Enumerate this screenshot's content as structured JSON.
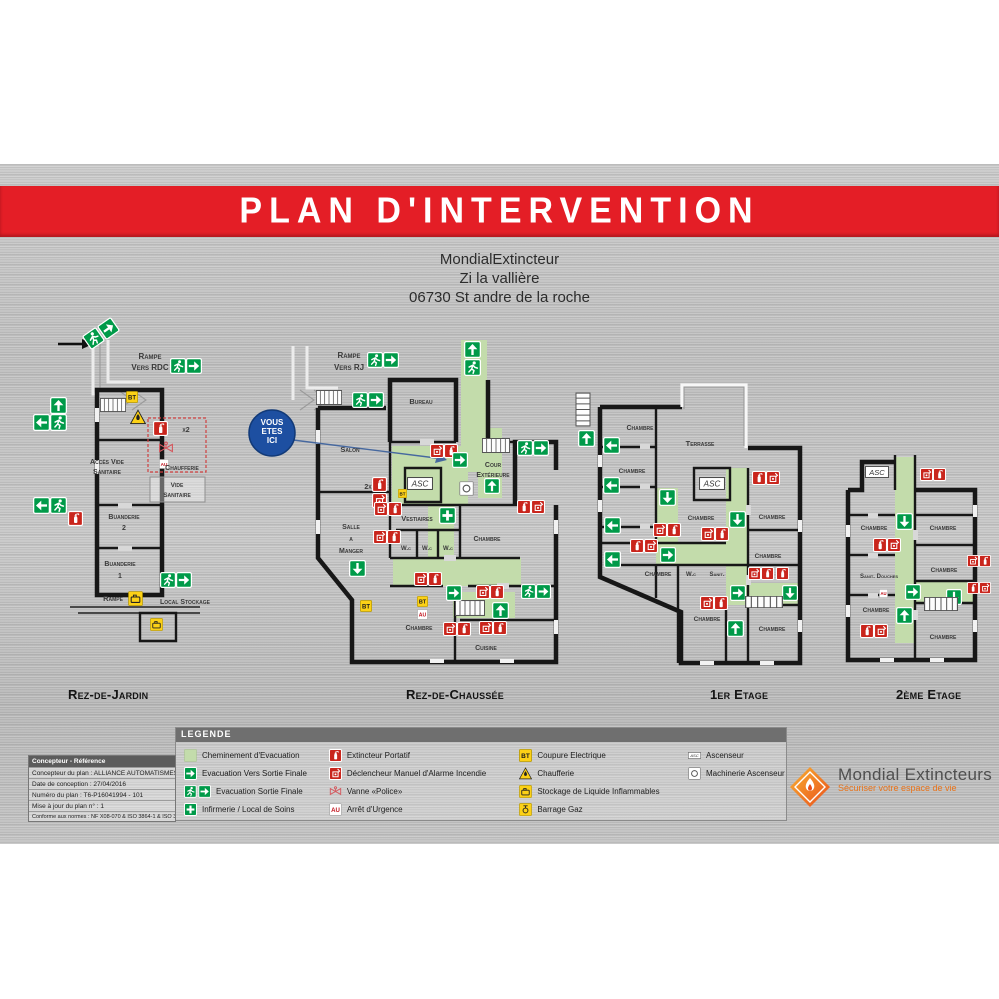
{
  "poster": {
    "title": "PLAN D'INTERVENTION",
    "address_lines": [
      "MondialExtincteur",
      "Zi la vallière",
      "06730 St andre de la roche"
    ],
    "you_are_here": [
      "VOUS",
      "ETES",
      "ICI"
    ]
  },
  "colors": {
    "banner_red": "#e41e26",
    "safety_green": "#009a49",
    "evacuation_path_green": "#c3dcab",
    "icon_red": "#c9251c",
    "icon_yellow": "#fcd116",
    "you_are_here_blue": "#1d4fa1"
  },
  "floors": [
    {
      "id": "rdj",
      "label": "Rez-de-Jardin",
      "texts": [
        {
          "t": "Rampe",
          "x": 150,
          "y": 359,
          "s": 8
        },
        {
          "t": "Vers RDC",
          "x": 150,
          "y": 370,
          "s": 8
        },
        {
          "t": "x2",
          "x": 186,
          "y": 432,
          "s": 7
        },
        {
          "t": "Accès Vide",
          "x": 107,
          "y": 464,
          "s": 7
        },
        {
          "t": "Sanitaire",
          "x": 107,
          "y": 474,
          "s": 7
        },
        {
          "t": "Chaufferie",
          "x": 182,
          "y": 470,
          "s": 7
        },
        {
          "t": "Vide",
          "x": 177,
          "y": 487,
          "s": 6.5
        },
        {
          "t": "Sanitaire",
          "x": 177,
          "y": 497,
          "s": 6.5
        },
        {
          "t": "Buanderie",
          "x": 124,
          "y": 519,
          "s": 7
        },
        {
          "t": "2",
          "x": 124,
          "y": 530,
          "s": 7
        },
        {
          "t": "Buanderie",
          "x": 120,
          "y": 566,
          "s": 7
        },
        {
          "t": "1",
          "x": 120,
          "y": 578,
          "s": 7
        },
        {
          "t": "Rampe",
          "x": 113,
          "y": 601,
          "s": 7.5
        },
        {
          "t": "Local Stockage",
          "x": 185,
          "y": 604,
          "s": 7
        }
      ],
      "icons": [
        {
          "k": "stairs",
          "x": 100,
          "y": 398,
          "w": 26,
          "h": 14
        },
        {
          "k": "arrow",
          "x": 100,
          "y": 320,
          "s": 17,
          "r": -35
        },
        {
          "k": "runner",
          "x": 85,
          "y": 330,
          "s": 17,
          "r": -35
        },
        {
          "k": "runner",
          "x": 170,
          "y": 358,
          "s": 16
        },
        {
          "k": "arrow",
          "x": 186,
          "y": 358,
          "s": 16
        },
        {
          "k": "arrow",
          "x": 50,
          "y": 397,
          "s": 17,
          "r": 270
        },
        {
          "k": "arrow",
          "x": 33,
          "y": 414,
          "s": 17,
          "r": 180
        },
        {
          "k": "runner",
          "x": 50,
          "y": 414,
          "s": 17
        },
        {
          "k": "bt",
          "x": 126,
          "y": 391,
          "s": 12
        },
        {
          "k": "warn",
          "x": 130,
          "y": 409,
          "s": 16
        },
        {
          "k": "ext",
          "x": 153,
          "y": 421,
          "s": 15
        },
        {
          "k": "vanne",
          "x": 158,
          "y": 440,
          "s": 16
        },
        {
          "k": "au",
          "x": 159,
          "y": 459,
          "s": 10
        },
        {
          "k": "arrow",
          "x": 33,
          "y": 497,
          "s": 17,
          "r": 180
        },
        {
          "k": "runner",
          "x": 50,
          "y": 497,
          "s": 17
        },
        {
          "k": "ext",
          "x": 68,
          "y": 511,
          "s": 15
        },
        {
          "k": "runner",
          "x": 160,
          "y": 572,
          "s": 16
        },
        {
          "k": "arrow",
          "x": 176,
          "y": 572,
          "s": 16
        },
        {
          "k": "store",
          "x": 128,
          "y": 591,
          "s": 15
        },
        {
          "k": "store",
          "x": 150,
          "y": 618,
          "s": 13
        }
      ]
    },
    {
      "id": "rdc",
      "label": "Rez-de-Chaussée",
      "texts": [
        {
          "t": "Rampe",
          "x": 349,
          "y": 358,
          "s": 8
        },
        {
          "t": "Vers RJ",
          "x": 349,
          "y": 370,
          "s": 8
        },
        {
          "t": "Bureau",
          "x": 421,
          "y": 404,
          "s": 7.5
        },
        {
          "t": "Salon",
          "x": 350,
          "y": 452,
          "s": 7.5
        },
        {
          "t": "2x",
          "x": 368,
          "y": 489,
          "s": 7,
          "a": "end"
        },
        {
          "t": "Cour",
          "x": 493,
          "y": 467,
          "s": 7
        },
        {
          "t": "Extérieure",
          "x": 493,
          "y": 477,
          "s": 7
        },
        {
          "t": "Vestiaires",
          "x": 417,
          "y": 521,
          "s": 7.5
        },
        {
          "t": "Salle",
          "x": 351,
          "y": 529,
          "s": 7
        },
        {
          "t": "a",
          "x": 351,
          "y": 541,
          "s": 7
        },
        {
          "t": "Manger",
          "x": 351,
          "y": 553,
          "s": 7
        },
        {
          "t": "W.c",
          "x": 406,
          "y": 550,
          "s": 6
        },
        {
          "t": "W.c",
          "x": 427,
          "y": 550,
          "s": 6
        },
        {
          "t": "W.c",
          "x": 448,
          "y": 550,
          "s": 6
        },
        {
          "t": "Chambre",
          "x": 487,
          "y": 541,
          "s": 7
        },
        {
          "t": "Chambre",
          "x": 419,
          "y": 630,
          "s": 7
        },
        {
          "t": "Cuisine",
          "x": 486,
          "y": 650,
          "s": 7
        }
      ],
      "icons": [
        {
          "k": "stairs",
          "x": 316,
          "y": 390,
          "w": 26,
          "h": 15
        },
        {
          "k": "stairs",
          "x": 482,
          "y": 438,
          "w": 28,
          "h": 15
        },
        {
          "k": "stairs",
          "x": 455,
          "y": 600,
          "w": 30,
          "h": 16
        },
        {
          "k": "runner",
          "x": 367,
          "y": 352,
          "s": 16
        },
        {
          "k": "arrow",
          "x": 383,
          "y": 352,
          "s": 16
        },
        {
          "k": "runner",
          "x": 352,
          "y": 392,
          "s": 16
        },
        {
          "k": "arrow",
          "x": 368,
          "y": 392,
          "s": 16
        },
        {
          "k": "arrow",
          "x": 464,
          "y": 341,
          "s": 17,
          "r": 270
        },
        {
          "k": "runner",
          "x": 464,
          "y": 359,
          "s": 17
        },
        {
          "k": "alarm",
          "x": 430,
          "y": 444,
          "s": 14
        },
        {
          "k": "ext",
          "x": 444,
          "y": 444,
          "s": 14
        },
        {
          "k": "arrow",
          "x": 452,
          "y": 452,
          "s": 16
        },
        {
          "k": "ext",
          "x": 372,
          "y": 477,
          "s": 15
        },
        {
          "k": "alarm",
          "x": 372,
          "y": 493,
          "s": 15
        },
        {
          "k": "asc",
          "x": 407,
          "y": 477,
          "w": 26,
          "h": 13
        },
        {
          "k": "bt",
          "x": 398,
          "y": 489,
          "s": 9
        },
        {
          "k": "mach",
          "x": 459,
          "y": 481,
          "s": 15
        },
        {
          "k": "arrow",
          "x": 484,
          "y": 478,
          "s": 16,
          "r": 270
        },
        {
          "k": "runner",
          "x": 517,
          "y": 440,
          "s": 16
        },
        {
          "k": "arrow",
          "x": 533,
          "y": 440,
          "s": 16
        },
        {
          "k": "ext",
          "x": 517,
          "y": 500,
          "s": 14
        },
        {
          "k": "alarm",
          "x": 531,
          "y": 500,
          "s": 14
        },
        {
          "k": "cross",
          "x": 439,
          "y": 507,
          "s": 17
        },
        {
          "k": "alarm",
          "x": 374,
          "y": 502,
          "s": 14
        },
        {
          "k": "ext",
          "x": 388,
          "y": 502,
          "s": 14
        },
        {
          "k": "alarm",
          "x": 373,
          "y": 530,
          "s": 14
        },
        {
          "k": "ext",
          "x": 387,
          "y": 530,
          "s": 14
        },
        {
          "k": "arrow",
          "x": 349,
          "y": 560,
          "s": 17,
          "r": 90
        },
        {
          "k": "alarm",
          "x": 414,
          "y": 572,
          "s": 14
        },
        {
          "k": "ext",
          "x": 428,
          "y": 572,
          "s": 14
        },
        {
          "k": "arrow",
          "x": 446,
          "y": 585,
          "s": 16
        },
        {
          "k": "alarm",
          "x": 476,
          "y": 585,
          "s": 14
        },
        {
          "k": "ext",
          "x": 490,
          "y": 585,
          "s": 14
        },
        {
          "k": "arrow",
          "x": 492,
          "y": 602,
          "s": 17,
          "r": 270
        },
        {
          "k": "bt",
          "x": 360,
          "y": 600,
          "s": 12
        },
        {
          "k": "bt",
          "x": 417,
          "y": 596,
          "s": 11
        },
        {
          "k": "au",
          "x": 417,
          "y": 609,
          "s": 11
        },
        {
          "k": "alarm",
          "x": 443,
          "y": 622,
          "s": 14
        },
        {
          "k": "ext",
          "x": 457,
          "y": 622,
          "s": 14
        },
        {
          "k": "alarm",
          "x": 479,
          "y": 621,
          "s": 14
        },
        {
          "k": "ext",
          "x": 493,
          "y": 621,
          "s": 14
        },
        {
          "k": "runner",
          "x": 521,
          "y": 584,
          "s": 15
        },
        {
          "k": "arrow",
          "x": 536,
          "y": 584,
          "s": 15
        }
      ]
    },
    {
      "id": "e1",
      "label": "1er Etage",
      "texts": [
        {
          "t": "Chambre",
          "x": 640,
          "y": 430,
          "s": 7
        },
        {
          "t": "Terrasse",
          "x": 700,
          "y": 446,
          "s": 7.5
        },
        {
          "t": "Chambre",
          "x": 632,
          "y": 473,
          "s": 6.5
        },
        {
          "t": "Chambre",
          "x": 701,
          "y": 520,
          "s": 6.5
        },
        {
          "t": "Chambre",
          "x": 772,
          "y": 519,
          "s": 6.5
        },
        {
          "t": "Chambre",
          "x": 768,
          "y": 558,
          "s": 6.5
        },
        {
          "t": "Chambre",
          "x": 658,
          "y": 576,
          "s": 6.5
        },
        {
          "t": "W.c",
          "x": 691,
          "y": 576,
          "s": 6
        },
        {
          "t": "Sanit.",
          "x": 717,
          "y": 576,
          "s": 6
        },
        {
          "t": "Chambre",
          "x": 707,
          "y": 621,
          "s": 6.5
        },
        {
          "t": "Chambre",
          "x": 772,
          "y": 631,
          "s": 6.5
        }
      ],
      "icons": [
        {
          "k": "stairs",
          "x": 566,
          "y": 402,
          "w": 34,
          "h": 15,
          "r": 90
        },
        {
          "k": "arrow",
          "x": 578,
          "y": 430,
          "s": 17,
          "r": 270
        },
        {
          "k": "arrow",
          "x": 603,
          "y": 437,
          "s": 17,
          "r": 180
        },
        {
          "k": "arrow",
          "x": 603,
          "y": 477,
          "s": 17,
          "r": 180
        },
        {
          "k": "arrow",
          "x": 604,
          "y": 517,
          "s": 17,
          "r": 180
        },
        {
          "k": "arrow",
          "x": 604,
          "y": 551,
          "s": 17,
          "r": 180
        },
        {
          "k": "arrow",
          "x": 659,
          "y": 489,
          "s": 17,
          "r": 90
        },
        {
          "k": "asc",
          "x": 699,
          "y": 477,
          "w": 26,
          "h": 13
        },
        {
          "k": "ext",
          "x": 752,
          "y": 471,
          "s": 14
        },
        {
          "k": "alarm",
          "x": 766,
          "y": 471,
          "s": 14
        },
        {
          "k": "arrow",
          "x": 729,
          "y": 511,
          "s": 17,
          "r": 90
        },
        {
          "k": "alarm",
          "x": 653,
          "y": 523,
          "s": 14
        },
        {
          "k": "ext",
          "x": 667,
          "y": 523,
          "s": 14
        },
        {
          "k": "alarm",
          "x": 701,
          "y": 527,
          "s": 14
        },
        {
          "k": "ext",
          "x": 715,
          "y": 527,
          "s": 14
        },
        {
          "k": "ext",
          "x": 630,
          "y": 539,
          "s": 14
        },
        {
          "k": "alarm",
          "x": 644,
          "y": 539,
          "s": 14
        },
        {
          "k": "arrow",
          "x": 660,
          "y": 547,
          "s": 16
        },
        {
          "k": "alarm",
          "x": 748,
          "y": 567,
          "s": 13
        },
        {
          "k": "ext",
          "x": 761,
          "y": 567,
          "s": 13
        },
        {
          "k": "ext",
          "x": 776,
          "y": 567,
          "s": 13
        },
        {
          "k": "arrow",
          "x": 730,
          "y": 585,
          "s": 16
        },
        {
          "k": "arrow",
          "x": 782,
          "y": 585,
          "s": 16,
          "r": 90
        },
        {
          "k": "stairs",
          "x": 745,
          "y": 596,
          "w": 38,
          "h": 12
        },
        {
          "k": "alarm",
          "x": 700,
          "y": 596,
          "s": 14
        },
        {
          "k": "ext",
          "x": 714,
          "y": 596,
          "s": 14
        },
        {
          "k": "arrow",
          "x": 727,
          "y": 620,
          "s": 17,
          "r": 270
        }
      ]
    },
    {
      "id": "e2",
      "label": "2ème Etage",
      "texts": [
        {
          "t": "Chambre",
          "x": 874,
          "y": 530,
          "s": 6.5
        },
        {
          "t": "Chambre",
          "x": 943,
          "y": 530,
          "s": 6.5
        },
        {
          "t": "Sanit. Douches",
          "x": 879,
          "y": 578,
          "s": 6
        },
        {
          "t": "Chambre",
          "x": 944,
          "y": 572,
          "s": 6.5
        },
        {
          "t": "Chambre",
          "x": 876,
          "y": 612,
          "s": 6.5
        },
        {
          "t": "Chambre",
          "x": 943,
          "y": 639,
          "s": 6.5
        }
      ],
      "icons": [
        {
          "k": "asc",
          "x": 864,
          "y": 466,
          "w": 26,
          "h": 12
        },
        {
          "k": "alarm",
          "x": 920,
          "y": 468,
          "s": 13
        },
        {
          "k": "ext",
          "x": 933,
          "y": 468,
          "s": 13
        },
        {
          "k": "arrow",
          "x": 896,
          "y": 513,
          "s": 17,
          "r": 90
        },
        {
          "k": "ext",
          "x": 873,
          "y": 538,
          "s": 14
        },
        {
          "k": "alarm",
          "x": 887,
          "y": 538,
          "s": 14
        },
        {
          "k": "au",
          "x": 879,
          "y": 589,
          "s": 9
        },
        {
          "k": "arrow",
          "x": 905,
          "y": 584,
          "s": 16
        },
        {
          "k": "arrow",
          "x": 946,
          "y": 589,
          "s": 16,
          "r": 90
        },
        {
          "k": "stairs",
          "x": 924,
          "y": 597,
          "w": 34,
          "h": 14
        },
        {
          "k": "arrow",
          "x": 896,
          "y": 607,
          "s": 17,
          "r": 270
        },
        {
          "k": "ext",
          "x": 860,
          "y": 624,
          "s": 14
        },
        {
          "k": "alarm",
          "x": 874,
          "y": 624,
          "s": 14
        },
        {
          "k": "alarm",
          "x": 967,
          "y": 555,
          "s": 12
        },
        {
          "k": "ext",
          "x": 979,
          "y": 555,
          "s": 12
        },
        {
          "k": "ext",
          "x": 967,
          "y": 582,
          "s": 12
        },
        {
          "k": "alarm",
          "x": 979,
          "y": 582,
          "s": 12
        }
      ]
    }
  ],
  "legend": {
    "title": "LEGENDE",
    "columns": [
      {
        "items": [
          {
            "icon": "path",
            "label": "Cheminement d'Evacuation"
          },
          {
            "icon": "arrow",
            "label": "Evacuation Vers Sortie Finale"
          },
          {
            "icon": "exitfinal",
            "label": "Evacuation Sortie Finale"
          },
          {
            "icon": "cross",
            "label": "Infirmerie / Local de Soins"
          }
        ]
      },
      {
        "items": [
          {
            "icon": "ext",
            "label": "Extincteur Portatif"
          },
          {
            "icon": "alarm",
            "label": "Déclencheur Manuel d'Alarme Incendie"
          },
          {
            "icon": "vanne",
            "label": "Vanne «Police»"
          },
          {
            "icon": "au",
            "label": "Arrêt d'Urgence"
          }
        ]
      },
      {
        "items": [
          {
            "icon": "bt",
            "label": "Coupure Electrique"
          },
          {
            "icon": "warn",
            "label": "Chaufferie"
          },
          {
            "icon": "store",
            "label": "Stockage de Liquide Inflammables"
          },
          {
            "icon": "gas",
            "label": "Barrage Gaz"
          }
        ]
      },
      {
        "items": [
          {
            "icon": "asc",
            "label": "Ascenseur"
          },
          {
            "icon": "mach",
            "label": "Machinerie Ascenseur"
          }
        ]
      }
    ]
  },
  "designer_box": {
    "header": "Concepteur - Référence",
    "rows": [
      "Concepteur du plan : ALLIANCE AUTOMATISMES",
      "Date de conception : 27/04/2016",
      "Numéro du plan : T6-P16041994 - 101",
      "Mise à jour du plan n° : 1",
      "Conforme aux normes : NF X08-070 & ISO 3864-1 & ISO 3864-3"
    ]
  },
  "logo": {
    "name": "Mondial Extincteurs",
    "tagline": "Sécuriser votre espace de vie"
  }
}
